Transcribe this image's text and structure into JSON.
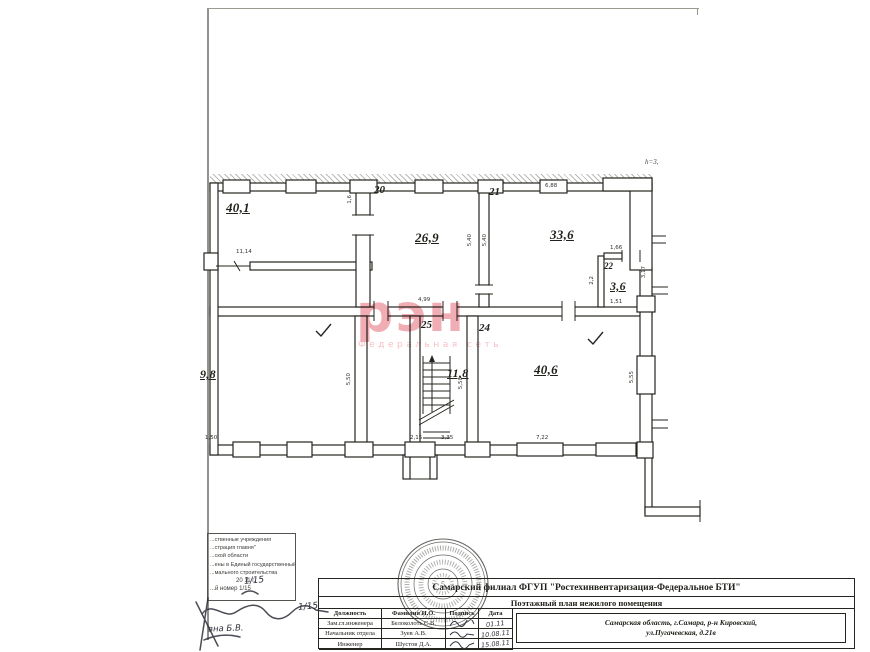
{
  "watermark": {
    "logo": "рэн",
    "subtitle": "Федеральная сеть",
    "color": "#ec8e97"
  },
  "plan": {
    "height_note": "h=3,",
    "rooms": [
      {
        "number": "20",
        "area": "26,9"
      },
      {
        "number": "21",
        "area": "33,6"
      },
      {
        "number": "22",
        "area": "3,6"
      },
      {
        "number": "25",
        "area": "11,8"
      },
      {
        "number": "24",
        "area": "40,6"
      },
      {
        "number": "",
        "area": "40,1"
      },
      {
        "number": "",
        "area": "9,8"
      }
    ],
    "dims": [
      "6,88",
      "1,6",
      "5,40",
      "5,40",
      "11,14",
      "1,66",
      "3,17",
      "2,2",
      "1,51",
      "4,99",
      "5,50",
      "5,50",
      "5,55",
      "1,50",
      "2,15",
      "3,35",
      "7,22"
    ]
  },
  "stamp": {
    "lines": [
      "...ственные учреждения",
      "...страция главня\"",
      "...ской области",
      "...ены в Единый государственный",
      "...мального строительства",
      "20  11 г.",
      "...й номер 1/15"
    ],
    "handwriting": {
      "top": "1/15",
      "line": "1/15",
      "signoff": "вна  Б.В."
    }
  },
  "seal": {
    "center": "5"
  },
  "title_block": {
    "org": "Самарский филиал ФГУП \"Ростехинвентаризация-Федеральное БТИ\"",
    "doc_title": "Поэтажный план нежилого помещения",
    "address_line1": "Самарская область, г.Самара, р-н Кировский,",
    "address_line2": "ул.Пугачевская, д.21в",
    "table": {
      "headers": [
        "Должность",
        "Фамилия И.О.",
        "Подпись",
        "Дата"
      ],
      "rows": [
        {
          "position": "Зам.гл.инженера",
          "name": "Белоколоть С.В.",
          "date": "01.11"
        },
        {
          "position": "Начальник отдела",
          "name": "Зуев А.В.",
          "date": "10.08.11"
        },
        {
          "position": "Инженер",
          "name": "Шустов Д.А.",
          "date": "15.08.11"
        }
      ]
    }
  }
}
